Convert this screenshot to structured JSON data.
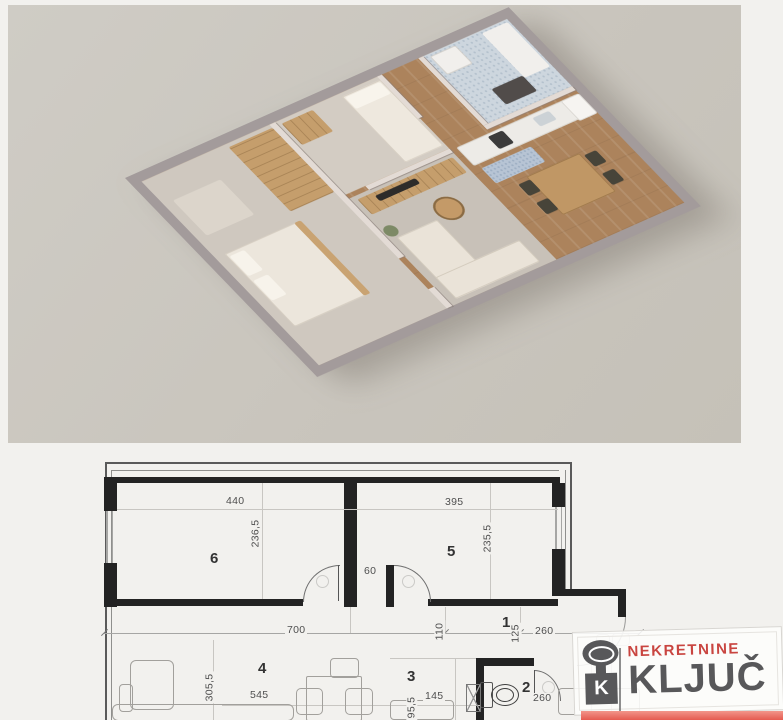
{
  "photo": {
    "description": "3D isometric render of one-bedroom apartment",
    "background_color": "#c9c5bd",
    "wall_color": "#a39b9b",
    "wood_floor_color": "#ac835c",
    "carpet_color": "#cfc8bf",
    "bathroom_tile_color": "#cdd6de"
  },
  "plan": {
    "labels": {
      "room1": "1",
      "room2": "2",
      "room3": "3",
      "room4": "4",
      "room5": "5",
      "room6": "6"
    },
    "dims": {
      "room6_width": "440",
      "room6_height": "236,5",
      "room5_width": "395",
      "room5_height": "235,5",
      "niche": "60",
      "room4_width": "700",
      "room4_height": "305,5",
      "room4_inner": "545",
      "hall_depth": "110",
      "hall_a": "125",
      "hall_b": "260",
      "kitchen_width": "145",
      "kitchen_height": "95,5",
      "wc_width": "260"
    }
  },
  "logo": {
    "brand_top": "NEKRETNINE",
    "brand_main": "KLJUČ",
    "key_letter": "K",
    "color_top": "#c94540",
    "color_main": "#58585a",
    "band_color": "#e55b50"
  }
}
